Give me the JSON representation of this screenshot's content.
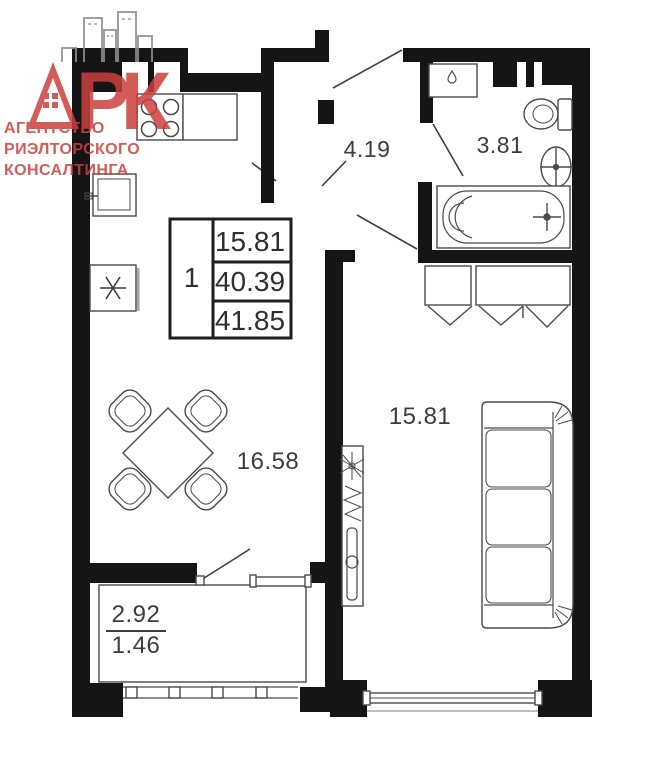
{
  "logo": {
    "brand": "АРК",
    "brand_suffix": "РК",
    "tagline": [
      "АГЕНТСТВО",
      "РИЭЛТОРСКОГО",
      "КОНСАЛТИНГА"
    ],
    "brand_color": "#c9403c",
    "skyline_color": "#8f8f8f"
  },
  "stamp": {
    "rooms_count": "1",
    "living_area": "15.81",
    "area_without_balcony": "40.39",
    "total_area": "41.85"
  },
  "rooms": [
    {
      "name": "hallway",
      "area": "4.19"
    },
    {
      "name": "bathroom",
      "area": "3.81"
    },
    {
      "name": "kitchen-dining",
      "area": "16.58"
    },
    {
      "name": "living-room",
      "area": "15.81"
    },
    {
      "name": "balcony",
      "area_full": "2.92",
      "area_counted": "1.46"
    }
  ],
  "fixtures": {
    "kitchen": [
      "stove",
      "counter",
      "sink",
      "refrigerator"
    ],
    "bathroom": [
      "washing-machine",
      "toilet",
      "wash-basin",
      "bathtub"
    ],
    "hallway": [
      "entry-door"
    ],
    "living_room": [
      "wardrobe",
      "sofa",
      "tv-console",
      "plant"
    ],
    "kitchen_dining": [
      "dining-table",
      "four-chairs",
      "balcony-door",
      "window"
    ]
  },
  "colors": {
    "walls": "#151515",
    "furniture_lines": "#4a4a4a",
    "labels": "#3c3c3c"
  }
}
